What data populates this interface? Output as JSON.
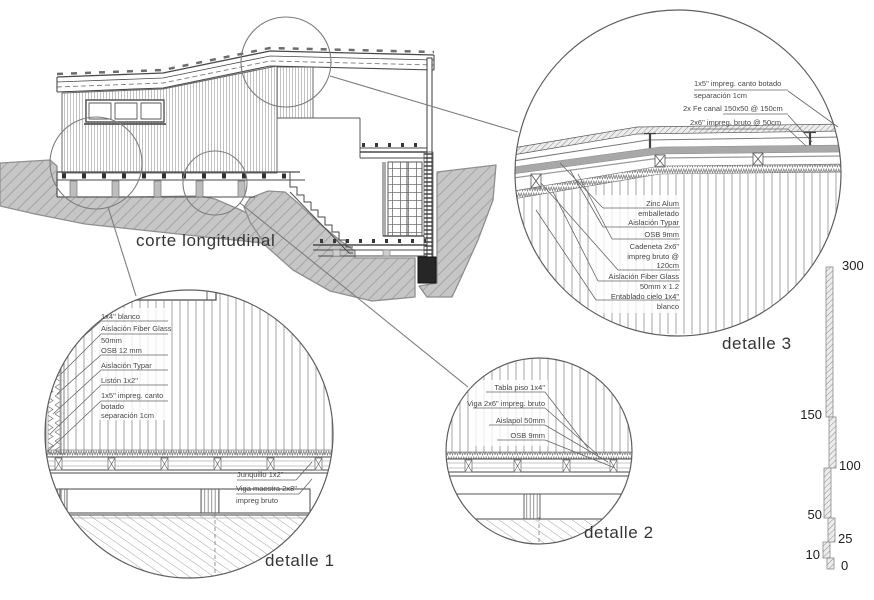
{
  "main": {
    "section_label": "corte longitudinal"
  },
  "d1": {
    "label": "detalle 1",
    "ann": {
      "a1": "1x4\" blanco",
      "a2a": "Aislación Fiber Glass",
      "a2b": "50mm",
      "a3": "OSB 12 mm",
      "a4": "Aislación Typar",
      "a5": "Listón 1x2\"",
      "a6a": "1x5\" impreg. canto",
      "a6b": "botado",
      "a6c": "separación 1cm",
      "a7": "Junquillo 1x2\"",
      "a8a": "Viga maestra 2x8\"",
      "a8b": "impreg bruto"
    }
  },
  "d2": {
    "label": "detalle 2",
    "ann": {
      "b1": "Tabla piso 1x4\"",
      "b2": "Viga 2x6\" impreg. bruto",
      "b3": "Aislapol 50mm",
      "b4": "OSB 9mm"
    }
  },
  "d3": {
    "label": "detalle 3",
    "ann_top": {
      "c1a": "1x5\" impreg. canto botado",
      "c1b": "separación 1cm",
      "c2": "2x Fe canal 150x50 @ 150cm",
      "c3": "2x6\" impreg. bruto @ 50cm"
    },
    "stack": {
      "s1a": "Zinc Alum",
      "s1b": "emballetado",
      "s2": "Aislación Typar",
      "s3": "OSB 9mm",
      "s4a": "Cadeneta 2x6\"",
      "s4b": "impreg bruto @",
      "s4c": "120cm",
      "s5a": "Aislación Fiber Glass",
      "s5b": "50mm x 1.2",
      "s6a": "Entablado cielo 1x4\"",
      "s6b": "blanco"
    }
  },
  "scale": {
    "v300": "300",
    "v150": "150",
    "v100": "100",
    "v50": "50",
    "v25": "25",
    "v10": "10",
    "v0": "0"
  }
}
